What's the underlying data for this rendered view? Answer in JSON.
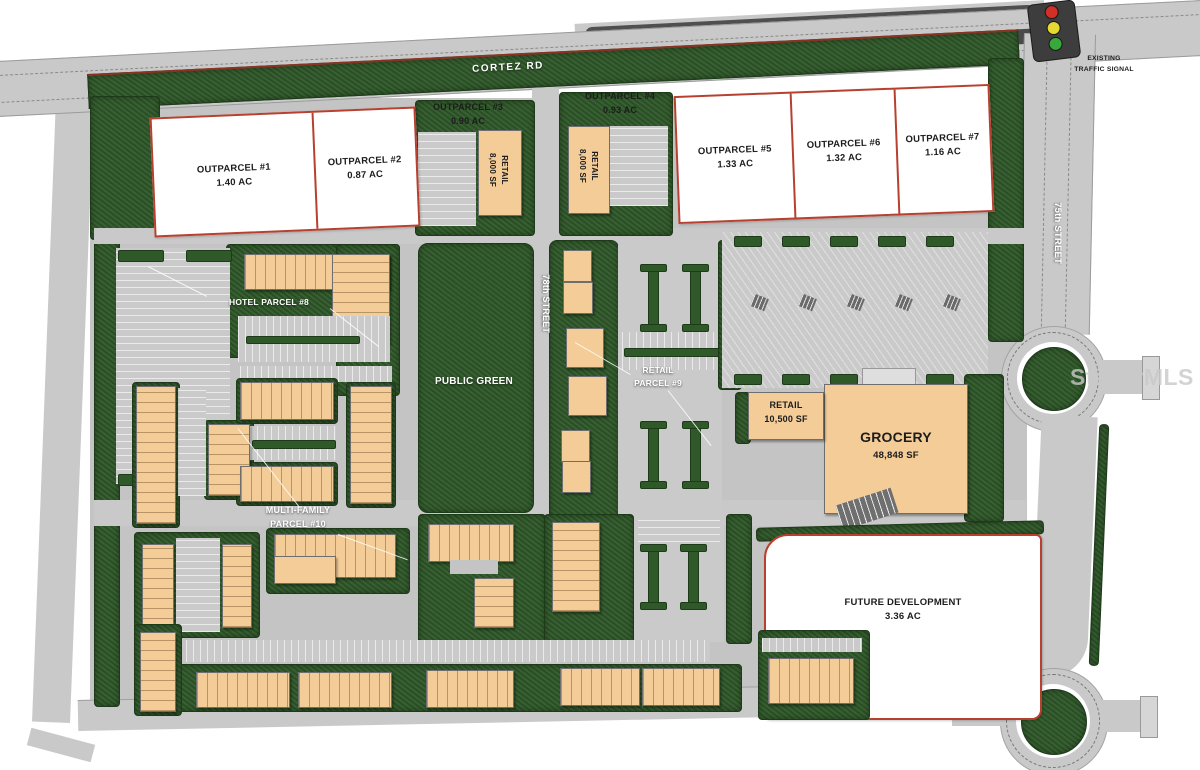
{
  "roads": {
    "cortez_rd": "CORTEZ RD",
    "street_78th": "78th STREET",
    "street_75th": "75th STREET"
  },
  "traffic_signal": {
    "line1": "EXISTING",
    "line2": "TRAFFIC SIGNAL"
  },
  "outparcels": [
    {
      "name": "OUTPARCEL #1",
      "area": "1.40 AC"
    },
    {
      "name": "OUTPARCEL #2",
      "area": "0.87 AC"
    },
    {
      "name": "OUTPARCEL #3",
      "area": "0.90 AC"
    },
    {
      "name": "OUTPARCEL #4",
      "area": "0.93 AC"
    },
    {
      "name": "OUTPARCEL #5",
      "area": "1.33 AC"
    },
    {
      "name": "OUTPARCEL #6",
      "area": "1.32 AC"
    },
    {
      "name": "OUTPARCEL #7",
      "area": "1.16 AC"
    }
  ],
  "future_development": {
    "name": "FUTURE DEVELOPMENT",
    "area": "3.36 AC"
  },
  "buildings": {
    "retail_west": {
      "name": "RETAIL",
      "size": "8,000 SF"
    },
    "retail_east": {
      "name": "RETAIL",
      "size": "8,000 SF"
    },
    "retail_inline": {
      "name": "RETAIL",
      "size": "10,500 SF"
    },
    "grocery": {
      "name": "GROCERY",
      "size": "48,848 SF"
    }
  },
  "callouts": {
    "hotel": "HOTEL PARCEL #8",
    "public_green": "PUBLIC GREEN",
    "retail_parcel9": {
      "line1": "RETAIL",
      "line2": "PARCEL #9"
    },
    "multi_family": {
      "line1": "MULTI-FAMILY",
      "line2": "PARCEL #10"
    }
  },
  "watermark": "StellarMLS",
  "colors": {
    "landscape_green": "#30592a",
    "road_gray": "#c9c9c9",
    "building_tan": "#f4cc98",
    "parcel_border_red": "#b8402f",
    "signal_red": "#d23027",
    "signal_yellow": "#e6d832",
    "signal_green": "#37a93c"
  }
}
